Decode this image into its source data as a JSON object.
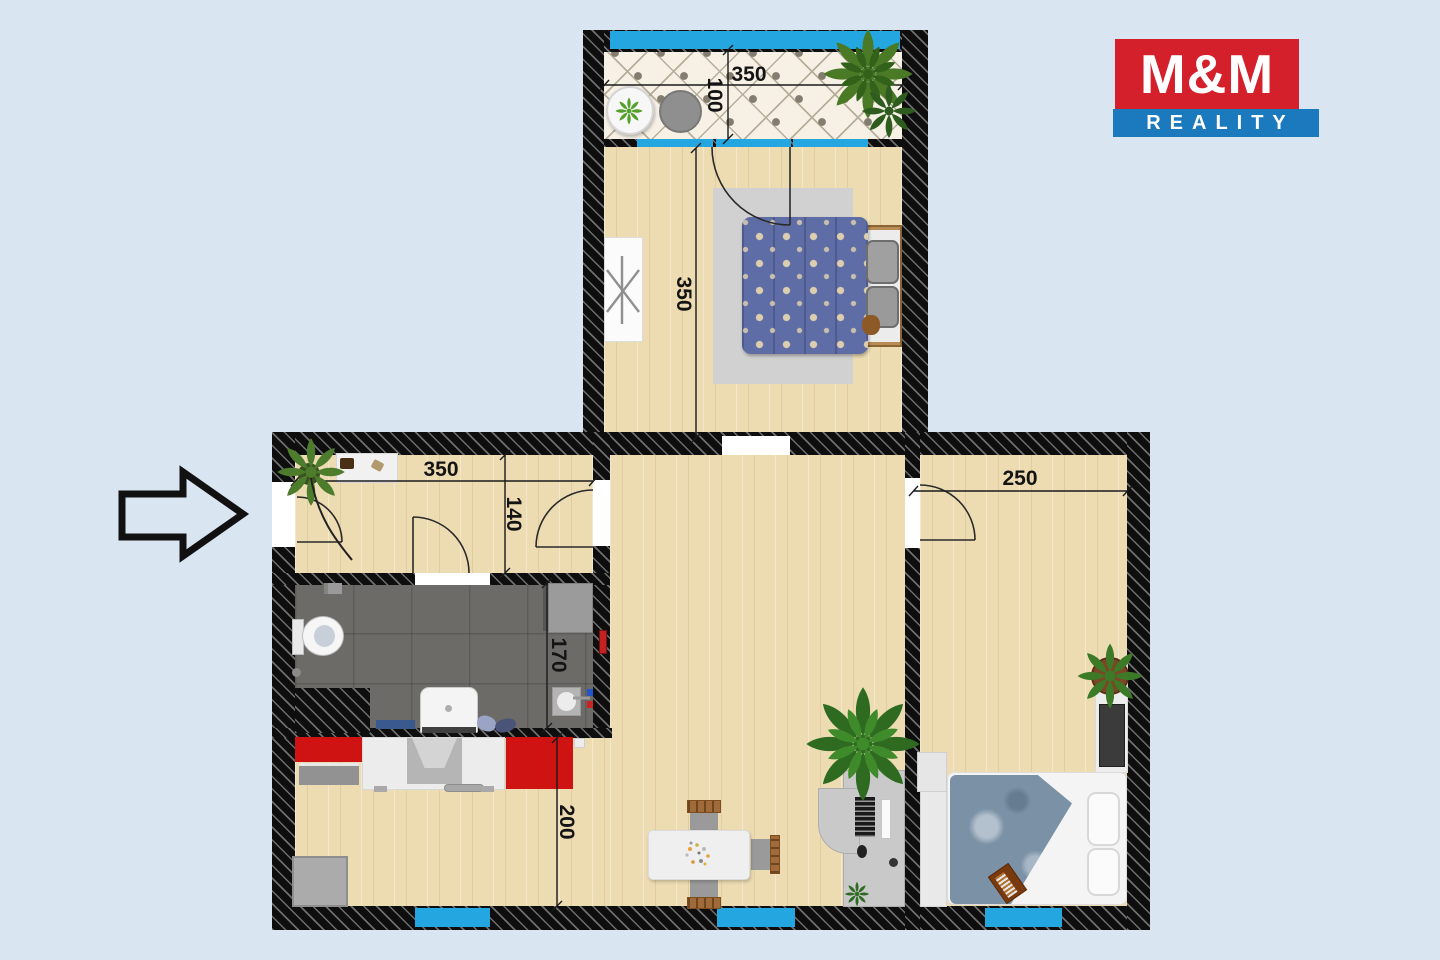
{
  "logo": {
    "title": "M&M",
    "subtitle": "REALITY",
    "colors": {
      "red": "#d4202a",
      "blue": "#1b79bd"
    }
  },
  "dims": {
    "balcony_width": "350",
    "balcony_depth": "100",
    "bedroom_length": "350",
    "hallway_width": "350",
    "hallway_depth": "140",
    "bathroom_depth": "170",
    "living_depth": "200",
    "room_width": "250"
  },
  "colors": {
    "background": "#d9e5f1",
    "walls": "#0e0e0e",
    "window_blue": "#24a7e1",
    "floor_wood": "#eddcb2",
    "floor_tile": "#f6f0e5",
    "floor_bath": "#6d6b68",
    "kitchen_red": "#cf1312"
  },
  "icons": {
    "entrance_arrow": "right-arrow",
    "plants": "potted-plant",
    "dryer_rack": "clothes-dryer"
  }
}
